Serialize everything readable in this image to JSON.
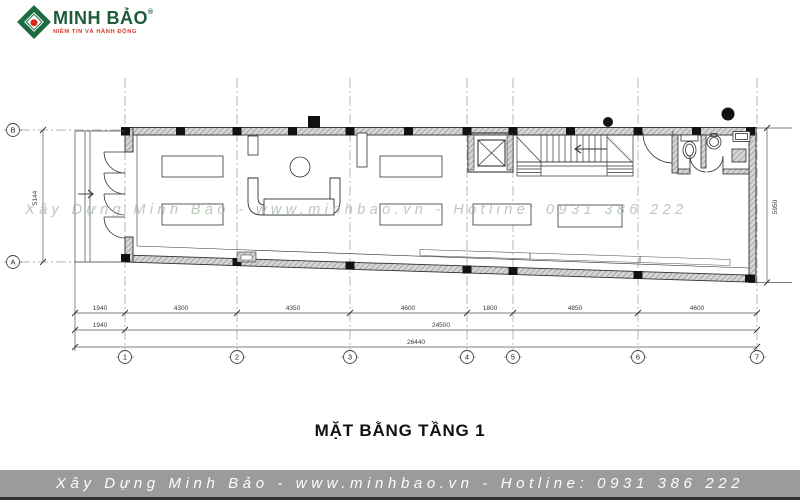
{
  "logo": {
    "brand": "MINH BẢO",
    "registered": "®",
    "tagline": "NIỀM TIN VÀ HÀNH ĐỘNG"
  },
  "title": "MẶT BẰNG TẦNG 1",
  "watermark": "Xây Dựng Minh Bảo - www.minhbao.vn - Hotline: 0931 386 222",
  "footer": {
    "text": "Xây Dựng Minh Bảo - www.minhbao.vn - Hotline: 0931 386 222"
  },
  "plan": {
    "dim_row1": [
      "1940",
      "4300",
      "4350",
      "4600",
      "1800",
      "4850",
      "4600"
    ],
    "dim_row2": [
      "1940",
      "24500"
    ],
    "dim_row3": [
      "26440"
    ],
    "dim_left": "5144",
    "dim_right": "5950",
    "grid_cols": [
      "1",
      "2",
      "3",
      "4",
      "5",
      "6",
      "7"
    ],
    "grid_rows": [
      "B",
      "A"
    ]
  },
  "colors": {
    "logo_green": "#1d5c38",
    "logo_red": "#d6261f",
    "footer_bg": "#9b9b9b",
    "watermark": "#9db29d"
  }
}
